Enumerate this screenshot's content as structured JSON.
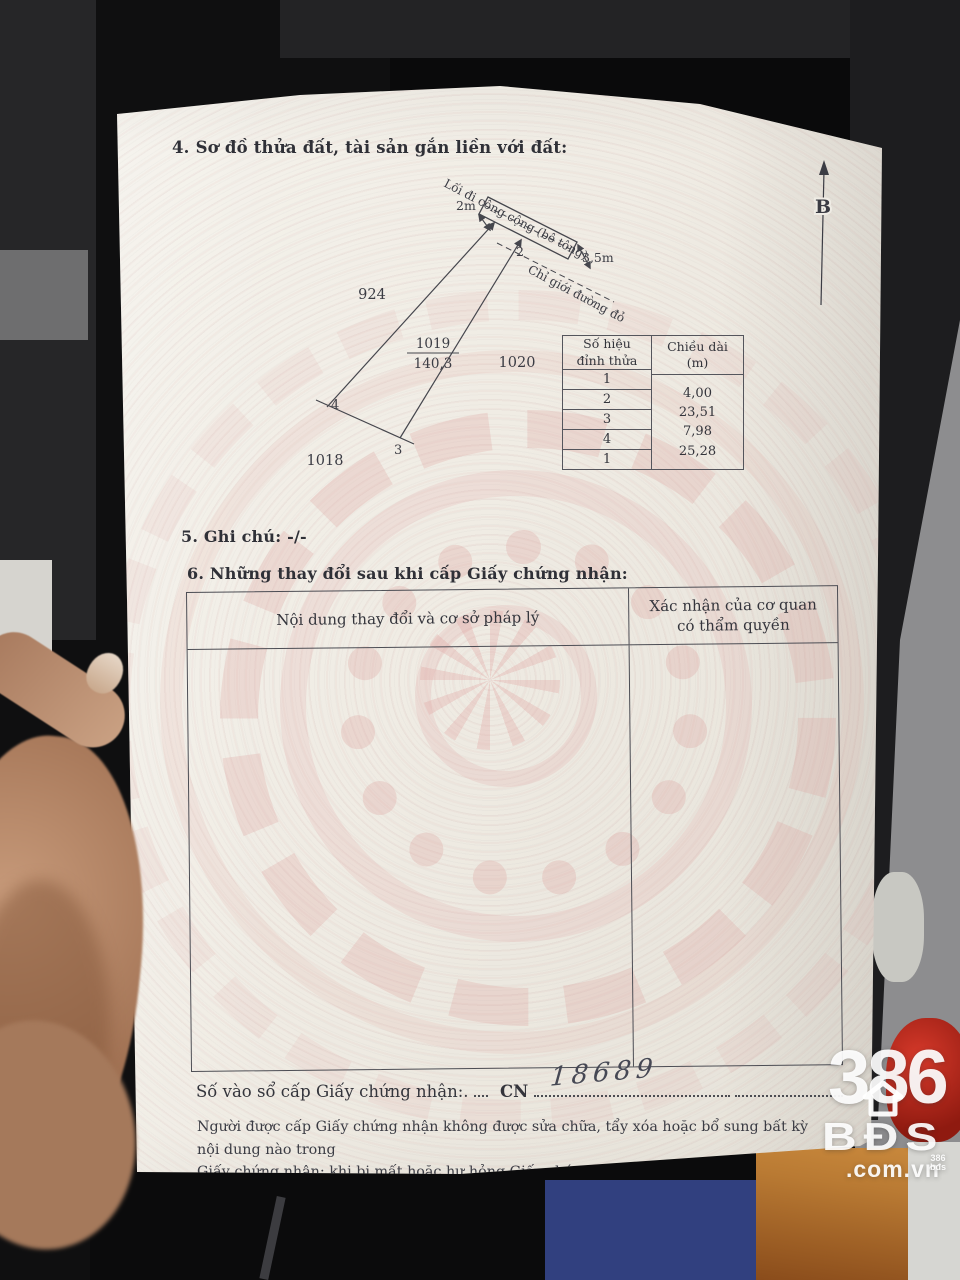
{
  "document": {
    "section4_title": "4. Sơ đồ thửa đất, tài sản gắn liền với đất:",
    "section5_title": "5. Ghi chú: -/-",
    "section6_title": "6. Những thay đổi sau khi cấp Giấy chứng nhận:",
    "registry_label": "Số vào sổ cấp Giấy chứng nhận:.",
    "registry_code": "CN",
    "registry_number_handwritten": "18689",
    "notice_line1": "Người được cấp Giấy chứng nhận không được sửa chữa, tẩy xóa hoặc bổ sung bất kỳ nội dung nào trong",
    "notice_line2": "Giấy chứng nhận; khi bị mất hoặc hư hỏng Giấy chứng nhận phải khai báo ngay với cơ quan cấp Giấy."
  },
  "diagram": {
    "north_label": "B",
    "road_label": "Lối đi công cộng (bê tông)",
    "red_boundary_label": "Chỉ giới đường đỏ",
    "width_left": "2m",
    "width_right": "3,5m",
    "parcel_number": "1019",
    "parcel_area_m2": "140,3",
    "neighbor_left": "924",
    "neighbor_right": "1020",
    "neighbor_bottom": "1018",
    "vertex_2": "2",
    "vertex_3": "3",
    "vertex_4": "4"
  },
  "edge_table": {
    "header_col1_line1": "Số hiệu",
    "header_col1_line2": "đỉnh thửa",
    "header_col2_line1": "Chiều dài",
    "header_col2_line2": "(m)",
    "vertex_ids": [
      "1",
      "2",
      "3",
      "4",
      "1"
    ],
    "lengths": [
      "4,00",
      "23,51",
      "7,98",
      "25,28"
    ]
  },
  "changes_table": {
    "header_col1": "Nội dung thay đổi và cơ sở pháp lý",
    "header_col2_line1": "Xác nhận của cơ quan",
    "header_col2_line2": "có thẩm quyền"
  },
  "watermark": {
    "number": "386",
    "brand": "BĐS",
    "domain": ".com.vn",
    "mini_number": "386",
    "mini_brand": "bđs"
  }
}
